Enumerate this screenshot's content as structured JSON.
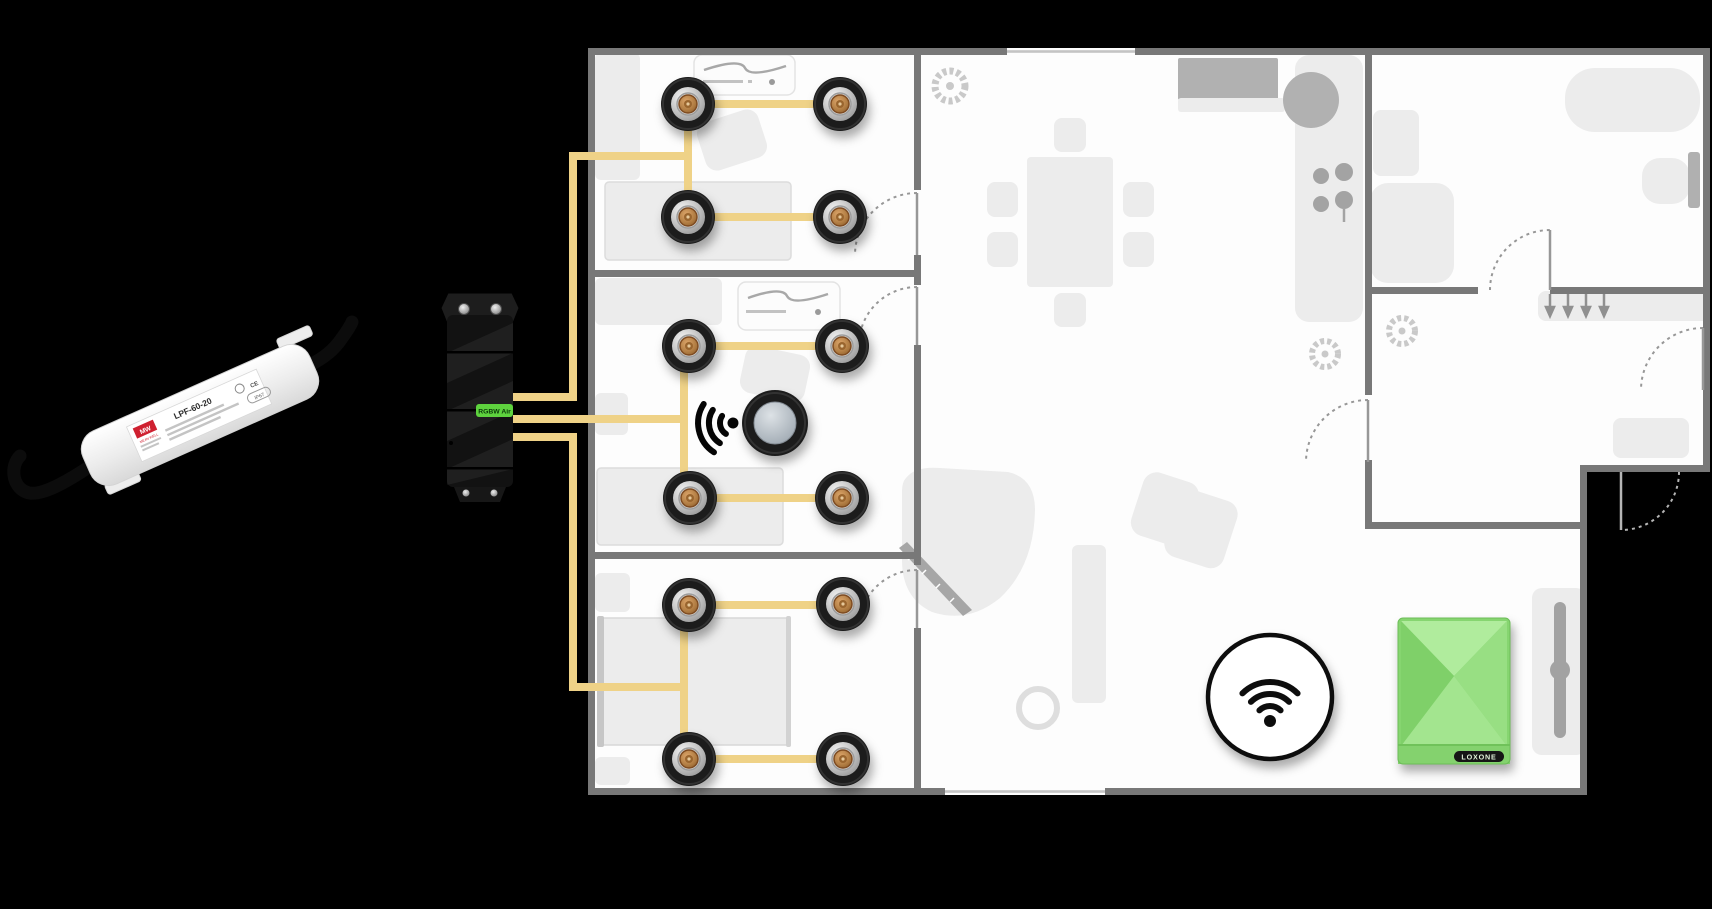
{
  "page": {
    "background": "#000000",
    "kind": "smart-home lighting wiring diagram over floor plan"
  },
  "devices": {
    "power_supply": {
      "name": "LED power supply",
      "brand": "MEAN WELL",
      "logo": "MW",
      "model": "LPF-60-20",
      "cert_ce": "CE",
      "cert_ip": "IP67",
      "body_color": "#f0f0f0",
      "cable_color": "#0c0c0c"
    },
    "dimmer": {
      "name": "RGBW dimmer",
      "label": "RGBW Air",
      "label_color": "#5ed33e",
      "body_color": "#121212"
    },
    "miniserver": {
      "name": "Miniserver Go",
      "badge": "LOXONE",
      "color": "#86d570"
    },
    "presence_sensor": {
      "name": "presence sensor",
      "dome_color": "#aab3bb"
    },
    "wifi_symbol": {
      "name": "wifi symbol"
    }
  },
  "wiring": {
    "color": "#efd287",
    "circuits": [
      {
        "room": "bedroom-top",
        "spotlights": 4
      },
      {
        "room": "bedroom-middle",
        "spotlights": 4,
        "devices": [
          "presence-sensor"
        ]
      },
      {
        "room": "bedroom-bottom",
        "spotlights": 4
      }
    ]
  },
  "floorplan": {
    "wall_color": "#787878",
    "floor_color": "#fdfdfd",
    "furniture_color": "#ececec",
    "rooms": [
      "bedroom-top",
      "bedroom-middle",
      "bedroom-bottom",
      "living-dining",
      "kitchen",
      "bathroom",
      "hall",
      "bedroom-right"
    ]
  }
}
